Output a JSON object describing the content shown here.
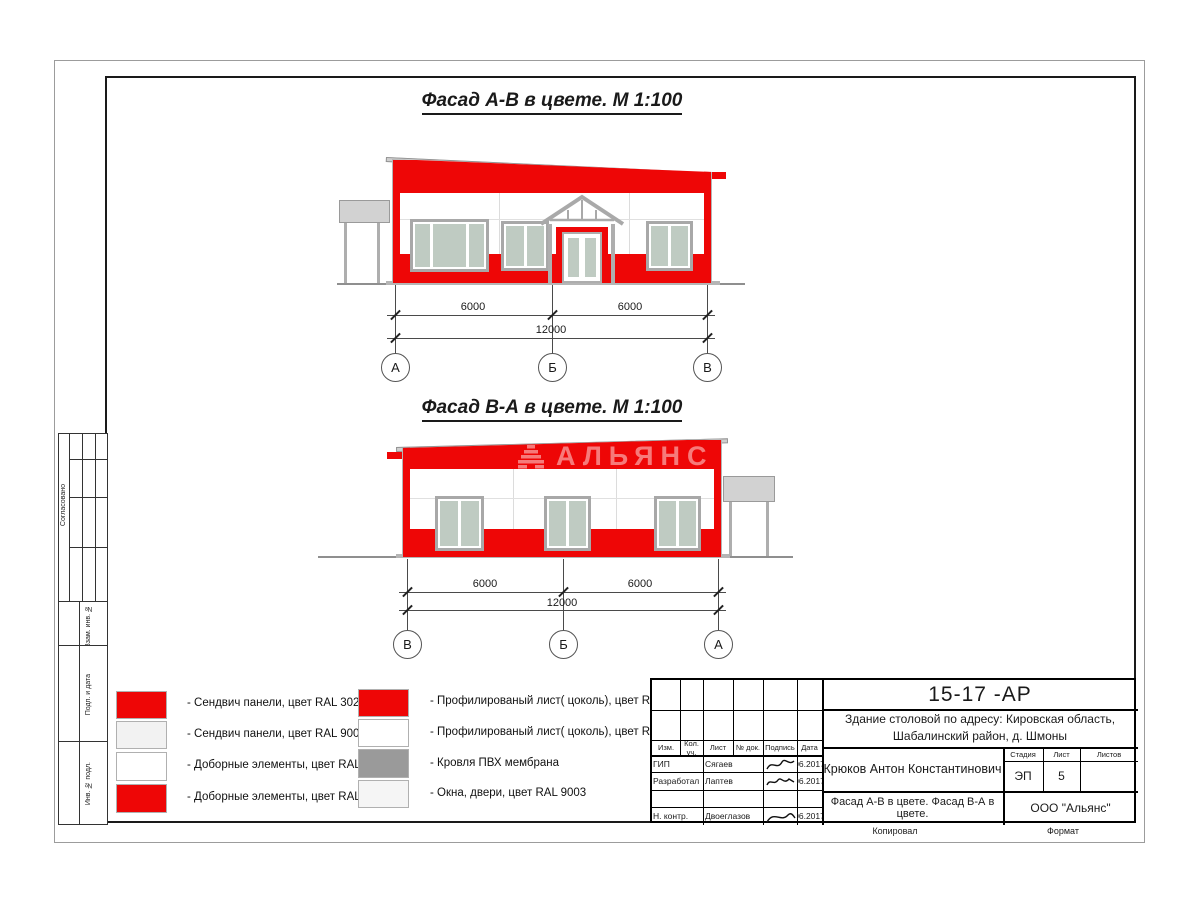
{
  "colors": {
    "red": "#ee0606",
    "glass": "#bfcbc2",
    "frame_gray": "#a8a8a8",
    "canopy_gray": "#d2d2d2",
    "membrane_gray": "#9a9a9a",
    "light_panel": "#f2f2f2",
    "white_panel": "#ffffff",
    "window_swatch": "#f5f5f5"
  },
  "titles": {
    "facade1": "Фасад А-В в цвете.  М 1:100",
    "facade2": "Фасад В-А в цвете.  М 1:100"
  },
  "watermark": {
    "text": "АЛЬЯНС"
  },
  "facade1": {
    "dim_left": "6000",
    "dim_right": "6000",
    "dim_total": "12000",
    "axis_left": "А",
    "axis_mid": "Б",
    "axis_right": "В"
  },
  "facade2": {
    "dim_left": "6000",
    "dim_right": "6000",
    "dim_total": "12000",
    "axis_left": "В",
    "axis_mid": "Б",
    "axis_right": "А"
  },
  "legend": {
    "left": [
      {
        "color": "#ee0606",
        "label": "- Сендвич панели, цвет RAL 3020"
      },
      {
        "color": "#f2f2f2",
        "label": "- Сендвич панели, цвет RAL 9003"
      },
      {
        "color": "#ffffff",
        "label": "- Доборные элементы, цвет RAL 9003"
      },
      {
        "color": "#ee0606",
        "label": "- Доборные элементы, цвет RAL 3020"
      }
    ],
    "right": [
      {
        "color": "#ee0606",
        "label": "- Профилированый лист( цоколь), цвет RAL 3020"
      },
      {
        "color": "#ffffff",
        "label": "- Профилированый лист( цоколь), цвет RAL 9003"
      },
      {
        "color": "#9a9a9a",
        "label": "- Кровля ПВХ мембрана"
      },
      {
        "color": "#f5f5f5",
        "label": "- Окна, двери, цвет RAL 9003"
      }
    ]
  },
  "stamp": {
    "doc_number": "15-17 -АР",
    "project_line1": "Здание столовой по адресу: Кировская область,",
    "project_line2": "Шабалинский район, д. Шмоны",
    "cols": [
      "Изм.",
      "Кол. уч.",
      "Лист",
      "№ док.",
      "Подпись",
      "Дата"
    ],
    "rows": [
      {
        "role": "ГИП",
        "name": "Сягаев",
        "date": "06.2017"
      },
      {
        "role": "Разработал",
        "name": "Лаптев",
        "date": "06.2017"
      },
      {
        "role": "",
        "name": "",
        "date": ""
      },
      {
        "role": "Н. контр.",
        "name": "Двоеглазов",
        "date": "06.2017"
      }
    ],
    "author": "Крюков Антон Константинович",
    "stage_label": "Стадия",
    "sheet_label": "Лист",
    "sheets_label": "Листов",
    "stage": "ЭП",
    "sheet": "5",
    "sheets": "",
    "subtitle": "Фасад А-В в цвете. Фасад В-А в цвете.",
    "company": "ООО \"Альянс\"",
    "copied": "Копировал",
    "format": "Формат"
  },
  "side_labels": {
    "agreed": "Согласовано",
    "replace_inv": "Взам. инв. №",
    "sign_date": "Подп. и дата",
    "inv_orig": "Инв. № подл."
  }
}
